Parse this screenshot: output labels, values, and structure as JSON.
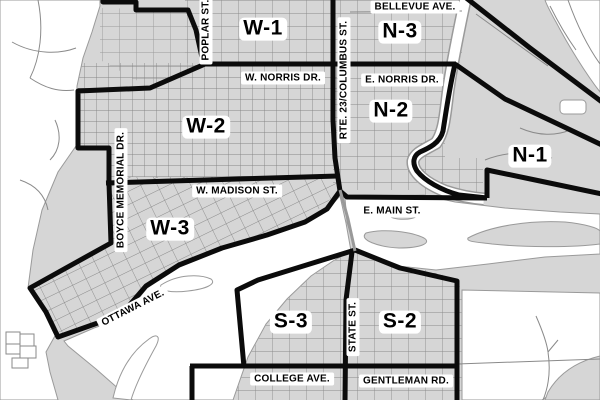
{
  "map": {
    "description": "City ward boundary map",
    "colors": {
      "land": "#d6d6d6",
      "outside": "#ffffff",
      "street_line": "#858585",
      "ward_boundary": "#0b0b0b",
      "river_outline": "#9a9a9a",
      "label_text": "#000000",
      "label_background": "#ffffff"
    },
    "wards": [
      {
        "label": "W-1"
      },
      {
        "label": "N-3"
      },
      {
        "label": "W-2"
      },
      {
        "label": "N-2"
      },
      {
        "label": "N-1"
      },
      {
        "label": "W-3"
      },
      {
        "label": "S-3"
      },
      {
        "label": "S-2"
      }
    ],
    "streets": [
      {
        "text": "BELLEVUE AVE."
      },
      {
        "text": "POPLAR ST."
      },
      {
        "text": "W. NORRIS DR."
      },
      {
        "text": "E. NORRIS DR."
      },
      {
        "text": "RTE. 23/COLUMBUS ST."
      },
      {
        "text": "W. MADISON ST."
      },
      {
        "text": "E. MAIN ST."
      },
      {
        "text": "BOYCE MEMORIAL DR."
      },
      {
        "text": "OTTAWA AVE."
      },
      {
        "text": "STATE ST."
      },
      {
        "text": "COLLEGE AVE."
      },
      {
        "text": "GENTLEMAN RD."
      }
    ]
  }
}
